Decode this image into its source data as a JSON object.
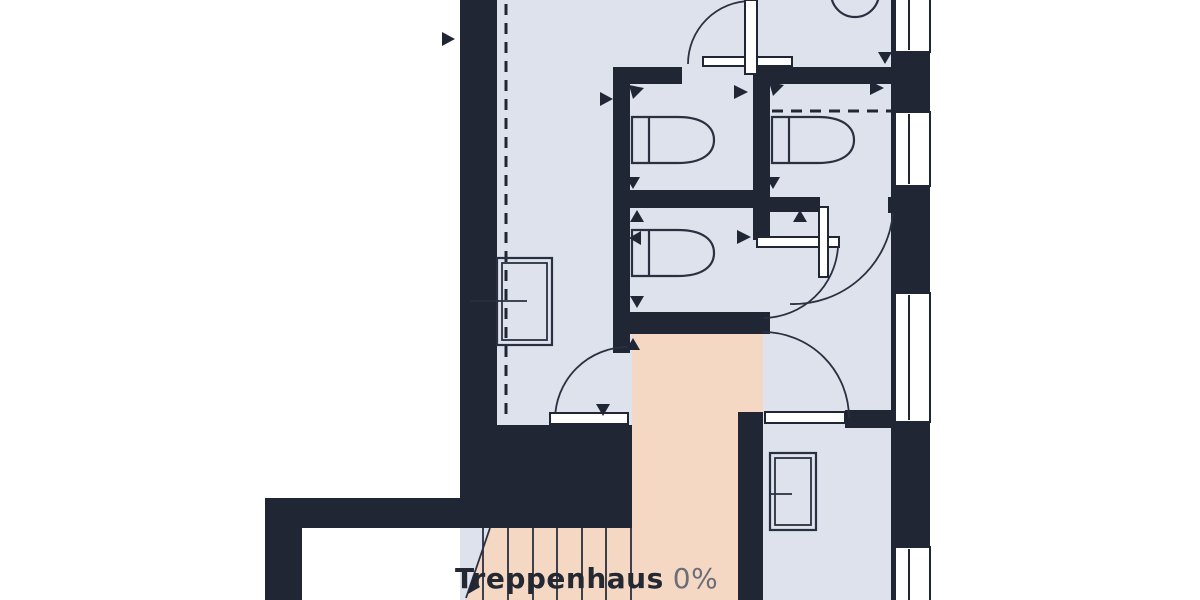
{
  "plan": {
    "room_label": "Treppenhaus",
    "room_value": "0%",
    "colors": {
      "wall": "#202634",
      "floor": "#dde2ed",
      "highlight": "#f5d8c3",
      "outside": "#ffffff",
      "line": "#2a3040",
      "label": "#232833",
      "value": "#6b6e78"
    }
  }
}
